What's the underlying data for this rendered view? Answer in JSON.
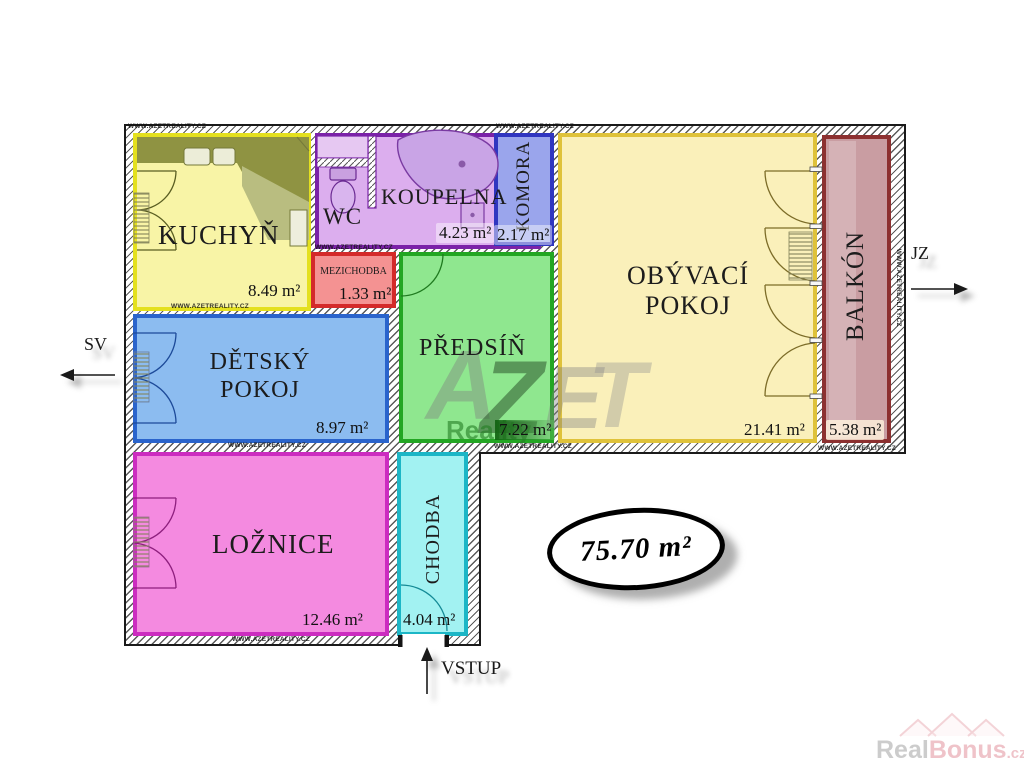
{
  "plan": {
    "total_area": "75.70 m²",
    "entrance": "VSTUP",
    "compass": {
      "left": "SV",
      "right": "JZ"
    },
    "rooms": [
      {
        "name": "KUCHYŇ",
        "area": "8.49 m²"
      },
      {
        "name": "WC",
        "area": ""
      },
      {
        "name": "KOUPELNA",
        "area": "4.23 m²"
      },
      {
        "name": "KOMORA",
        "area": "2.17 m²"
      },
      {
        "name": "MEZICHODBA",
        "area": "1.33 m²"
      },
      {
        "name": "PŘEDSÍŇ",
        "area": "7.22 m²"
      },
      {
        "name": "OBÝVACÍ POKOJ",
        "area": "21.41 m²"
      },
      {
        "name": "BALKÓN",
        "area": "5.38 m²"
      },
      {
        "name": "DĚTSKÝ POKOJ",
        "area": "8.97 m²"
      },
      {
        "name": "LOŽNICE",
        "area": "12.46 m²"
      },
      {
        "name": "CHODBA",
        "area": "4.04 m²"
      }
    ]
  },
  "watermark": {
    "letters": [
      "A",
      "Z",
      "E",
      "T"
    ],
    "sub": "Reality",
    "wall_text": "WWW.AZETREALITY.CZ"
  },
  "branding": {
    "gray": "Real",
    "pink": "Bonus",
    "tld": ".cz"
  },
  "colors": {
    "kuchyn": "#f8f4a6",
    "koupelna": "#dcaeee",
    "komora": "#9aa5ec",
    "mezichodba": "#f49292",
    "predsin": "#8fe78f",
    "obyvaci": "#faf0ba",
    "balkon": "#c99da2",
    "detsky": "#8cbcf0",
    "loznice": "#f48ae0",
    "chodba": "#a2f2f2"
  }
}
